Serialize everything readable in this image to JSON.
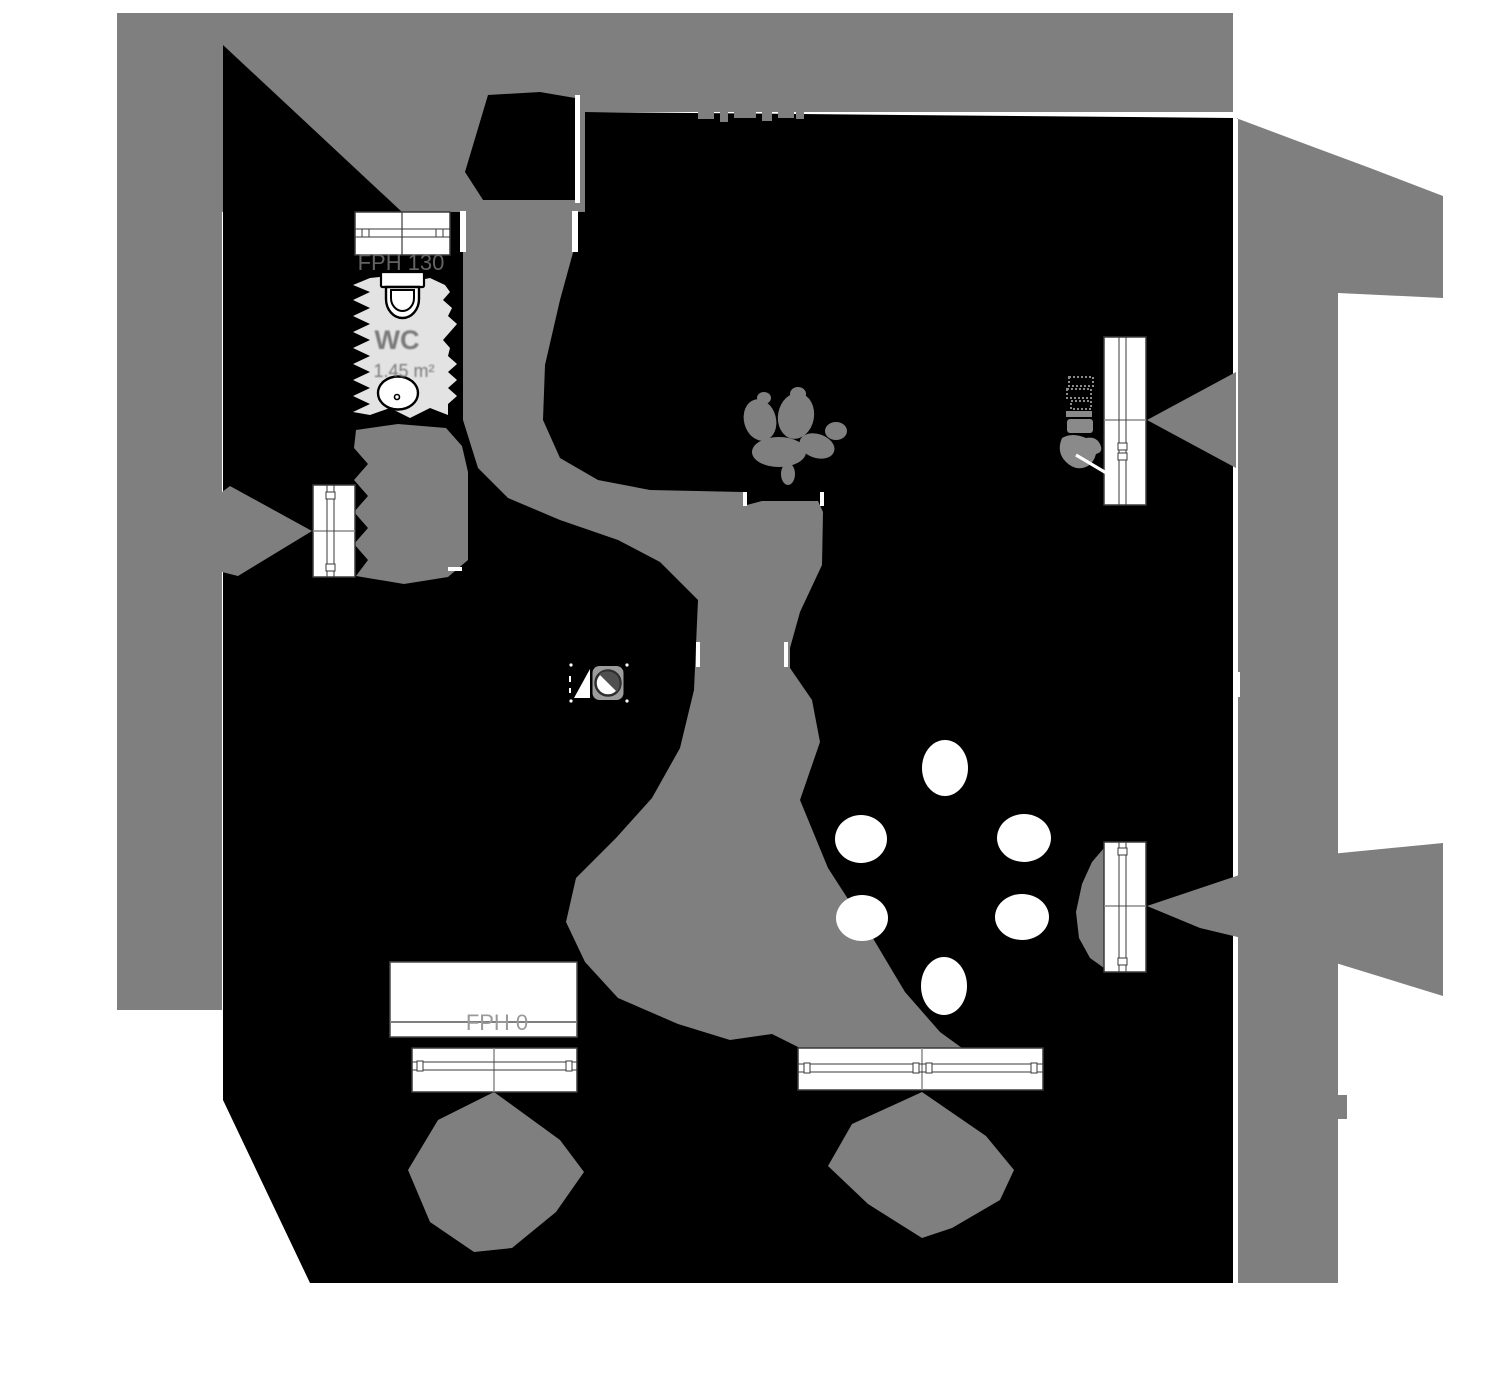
{
  "plan": {
    "type": "architectural-floor-plan",
    "labels": {
      "window_top_parapet": "FPH 130",
      "room_wc": "WC",
      "room_wc_area": "1.45 m²",
      "door_bottom_parapet": "FPH 0"
    },
    "fixtures": {
      "toilet": "toilet with cistern",
      "sink": "oval wash basin",
      "floor_symbol": "drain/light symbol",
      "radiator": "radiator with valve leader line",
      "plant": "plant blob"
    },
    "furniture": {
      "dining_chairs_count": "6"
    },
    "windows_count": "6",
    "colors": {
      "mass_black": "#000000",
      "mass_gray": "#7f7f7f",
      "wc_room_light_gray": "#e3e3e3",
      "fixture_white": "#ffffff",
      "outline_dark": "#3a3a3a",
      "text_gray": "#636363",
      "text_light_gray": "#9a9a9a"
    }
  }
}
